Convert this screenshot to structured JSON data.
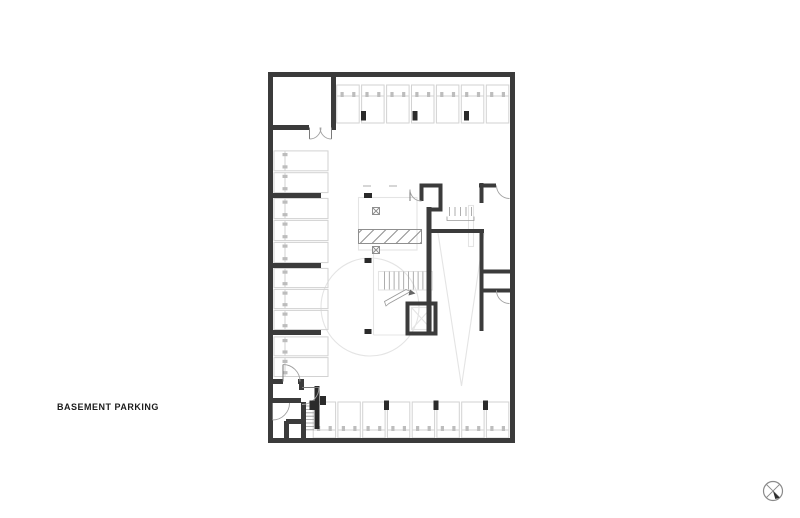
{
  "canvas": {
    "width": 800,
    "height": 518,
    "background": "#ffffff"
  },
  "plan": {
    "title": "BASEMENT PARKING",
    "colors": {
      "bg": "#ffffff",
      "wall": "#3b3b3b",
      "column": "#2a2a2a",
      "stall": "#d2d2d2",
      "stall_mark": "#bdbdbd",
      "light": "#e4e4e4",
      "detail": "#9a9a9a",
      "hatch": "#8f8f8f",
      "door": "#a2a2a2",
      "text": "#1c1c1c",
      "marker": "#8a8a8a"
    },
    "parking": {
      "top_row_stalls": 7,
      "bottom_row_stalls": 8,
      "left_bays": [
        2,
        3,
        3,
        2
      ],
      "total_stalls": 25
    },
    "features": [
      "stair-core",
      "elevator",
      "vehicle-ramp",
      "ramp-hatch",
      "turning-circle",
      "storage-room",
      "service-stair",
      "floor-drains"
    ],
    "north_marker": "circle-x"
  }
}
